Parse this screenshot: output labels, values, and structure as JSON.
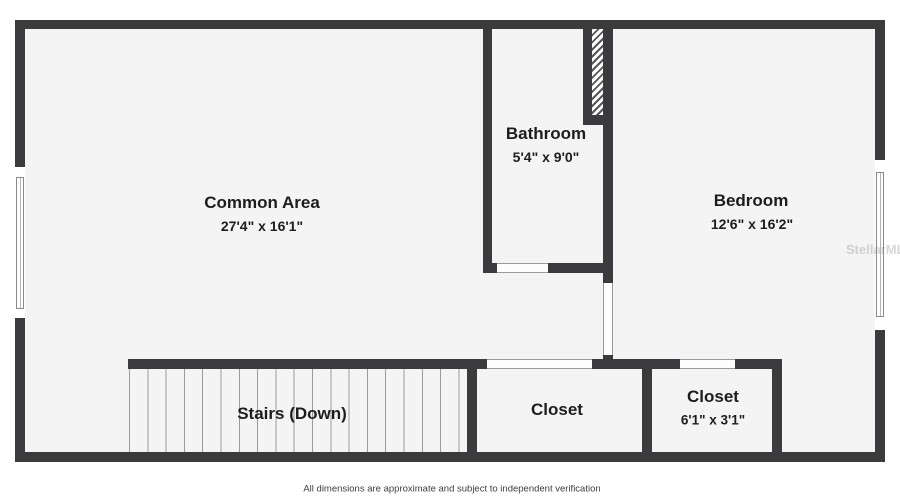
{
  "plan": {
    "rooms": {
      "common_area": {
        "name": "Common Area",
        "dims": "27'4\" x 16'1\""
      },
      "bathroom": {
        "name": "Bathroom",
        "dims": "5'4\" x 9'0\""
      },
      "bedroom": {
        "name": "Bedroom",
        "dims": "12'6\" x 16'2\""
      },
      "stairs": {
        "name": "Stairs (Down)"
      },
      "closet_left": {
        "name": "Closet"
      },
      "closet_right": {
        "name": "Closet",
        "dims": "6'1\" x 3'1\""
      }
    },
    "footer": "All dimensions are approximate and subject to independent verification",
    "watermark": "StellarMLS",
    "colors": {
      "wall": "#3b3b3d",
      "floor": "#f4f4f4",
      "outside": "#ffffff",
      "door_line": "#9a9a9a",
      "text": "#1d1d1f"
    }
  }
}
